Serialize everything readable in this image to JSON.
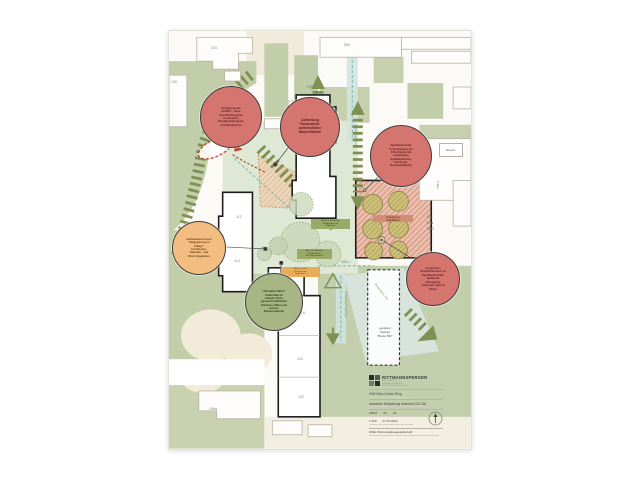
{
  "colors": {
    "stripe_green": "#7e9150",
    "field_green": "#c2cda9",
    "courtyard": "#dfe8d4",
    "teal": "#83b4ac",
    "bubble_red": "#d4756f",
    "bubble_orange": "#f3bc80",
    "bubble_green": "#a8b585",
    "hatch_red": "#c4604b",
    "beige": "#f1ebdc"
  },
  "plan": {
    "numbers": {
      "n104": "104",
      "n50b": "50b",
      "n106": "106",
      "n108": "108",
      "n110": "110",
      "n112": "112",
      "n114": "114",
      "n116": "116",
      "n118": "118",
      "n120": "120",
      "n122": "122",
      "n106a": "106a"
    },
    "labels": {
      "zentrum": "Zentrum",
      "am_buegel": "Am Bügel",
      "t_gar": "T-Gar",
      "buergerhaus": "Bürgerh.",
      "eg": "EG:",
      "kita": "KiTa",
      "abg": "ABG",
      "muell": "MÜLL",
      "uebergang_ost": "Übergang GL Ost",
      "uebergang_sued": "Übergang GL Süd",
      "uebergang_tg": "Übergang Tiefgarage",
      "zufahrt": "Zufahrt"
    },
    "erweiterung": {
      "line1": "Erweiterung",
      "line2": "KiTa-Fläche"
    },
    "planned_building": {
      "line1": "geplanter",
      "line2": "Neubau",
      "line3": "\"Bunter Bär\""
    },
    "area_boxes": [
      {
        "lines": [
          "Wiese 1 (extensiv):",
          "Obstbäume und",
          "Blühwiese"
        ]
      },
      {
        "lines": [
          "Wiese 2 (intensiv):",
          "Treffpunkt für",
          "alle Generationen"
        ]
      },
      {
        "lines": [
          "Wiese 3: KiTa-",
          "Reserve mit",
          "Spielwiese"
        ]
      }
    ],
    "bubbles": [
      {
        "lines": [
          "Verlegung der",
          "Zufahrt - neue",
          "Erschließung für",
          "Feuerwehr,",
          "Krankentransporte",
          "& Paketdienste"
        ]
      },
      {
        "lines": [
          "Aufwertung",
          "Pausenareal:",
          "aufenthaltliche",
          "Wasserflächen"
        ]
      },
      {
        "lines": [
          "Spiellandschaft",
          "in Verbindung zur",
          "KiTa-Fläche mit",
          "naturnahen",
          "Spielelementen,",
          "Erhalt der",
          "Bestandsbäume"
        ]
      },
      {
        "lines": [
          "Gebäudevorzonen",
          "\"Begegnung im",
          "Alltag\":",
          "Hochbeete,",
          "Stauden- und",
          "Obst-Vegetation"
        ]
      },
      {
        "lines": [
          "\"Attraktive Mitte\":",
          "Aufenthalt im",
          "ruhigen Grün,",
          "gemeinschaftliches",
          "Gärtnern, Wiese als",
          "grünes",
          "Klassenzimmer"
        ]
      },
      {
        "lines": [
          "Integration",
          "Schattenhecken in",
          "Spiellandschaft:",
          "fließende",
          "Übergänge",
          "zwischen Spiel &",
          "Natur"
        ]
      }
    ]
  },
  "titleblock": {
    "firm": "RITTMANNSPERGER",
    "sub": [
      "ARCHITEKTUR",
      "GENERALPLANUNG",
      "PROJEKTENTWICKLUNG"
    ],
    "project": "GWH Ben-Gurion-Ring",
    "drawing": "räumliche Zielplanung Innenhof 132-136",
    "fields": {
      "plan_no": "29010",
      "index": "04",
      "sheet": "A6",
      "scale": "1:200",
      "date": "17.05.2024"
    },
    "client": "GWH Wohnungsbaugesellschaft"
  }
}
